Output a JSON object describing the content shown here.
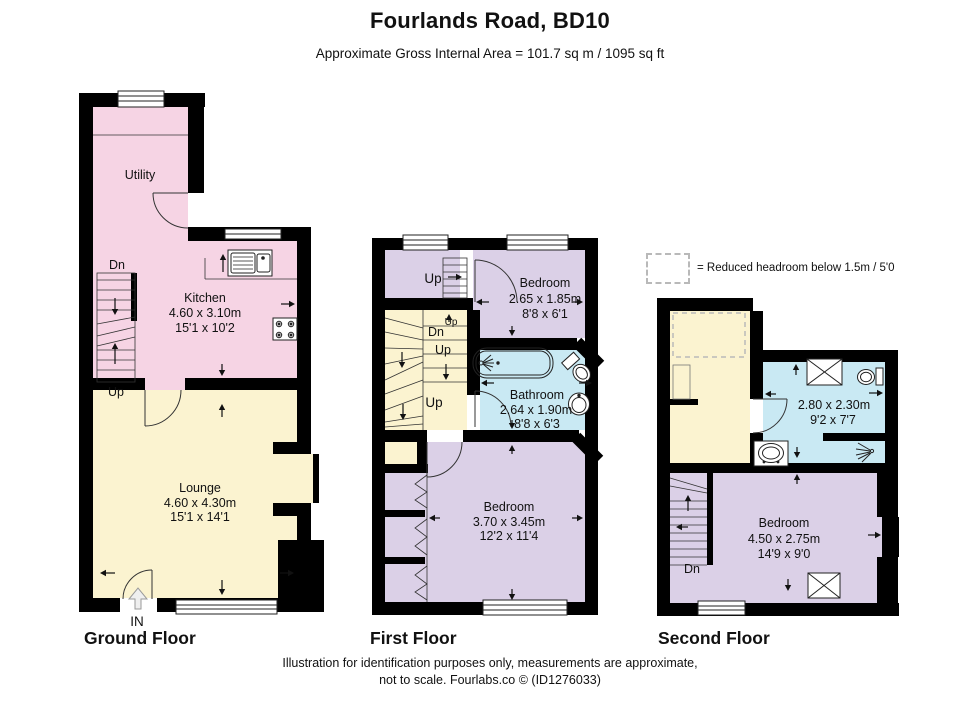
{
  "header": {
    "title": "Fourlands Road, BD10",
    "subtitle": "Approximate Gross Internal Area = 101.7 sq m / 1095 sq ft"
  },
  "legend": {
    "label": "= Reduced headroom below 1.5m / 5'0"
  },
  "ground": {
    "label": "Ground Floor",
    "utility": {
      "name": "Utility"
    },
    "kitchen": {
      "name": "Kitchen",
      "metric": "4.60 x 3.10m",
      "imperial": "15'1 x 10'2"
    },
    "lounge": {
      "name": "Lounge",
      "metric": "4.60 x 4.30m",
      "imperial": "15'1 x 14'1"
    },
    "dn": "Dn",
    "up": "Up",
    "entrance": "IN"
  },
  "first": {
    "label": "First Floor",
    "bedroom_small": {
      "name": "Bedroom",
      "metric": "2.65 x 1.85m",
      "imperial": "8'8 x 6'1"
    },
    "bathroom": {
      "name": "Bathroom",
      "metric": "2.64 x 1.90m",
      "imperial": "8'8 x 6'3"
    },
    "bedroom_large": {
      "name": "Bedroom",
      "metric": "3.70 x 3.45m",
      "imperial": "12'2 x 11'4"
    },
    "up_top": "Up",
    "up_small": "Up",
    "dn": "Dn",
    "up_mid": "Up",
    "up_big": "Up"
  },
  "second": {
    "label": "Second Floor",
    "shower_room": {
      "metric": "2.80 x 2.30m",
      "imperial": "9'2 x 7'7"
    },
    "bedroom": {
      "name": "Bedroom",
      "metric": "4.50 x 2.75m",
      "imperial": "14'9 x 9'0"
    },
    "dn": "Dn"
  },
  "footer": {
    "line1": "Illustration for identification purposes only, measurements are approximate,",
    "line2": "not to scale. Fourlabs.co © (ID1276033)"
  },
  "colors": {
    "room_pink": "#F6D4E4",
    "room_cream": "#FBF3D0",
    "room_purple": "#DBD0E7",
    "room_blue": "#C9E9F3",
    "wall": "#000000",
    "legend_dash": "#B9B9B9"
  }
}
